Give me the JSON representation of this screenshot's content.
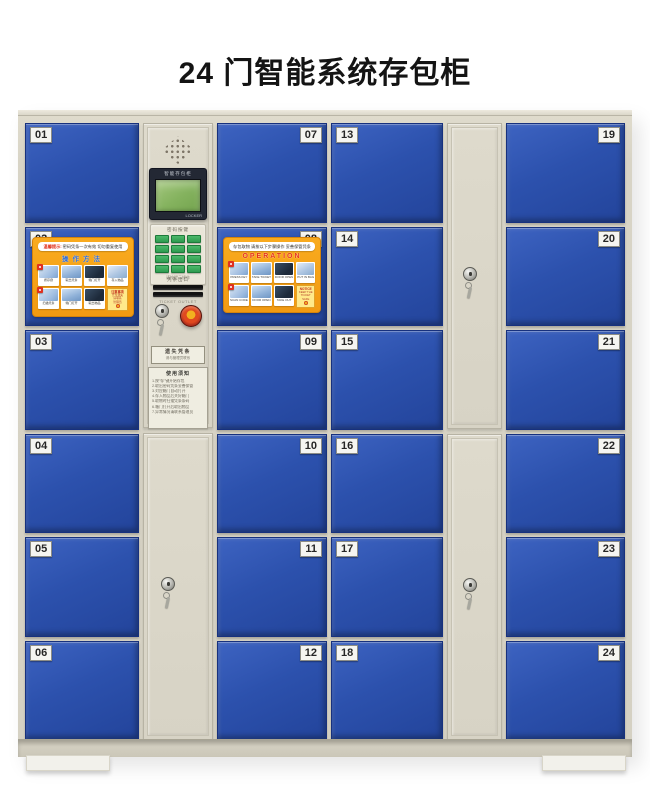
{
  "page": {
    "title": "24 门智能系统存包柜",
    "background": "#ffffff"
  },
  "colors": {
    "frame_beige": "#d8d4c6",
    "door_blue": "#2c51ad",
    "sticker_orange": "#f7a11a",
    "keypad_green": "#2e9b4f",
    "lcd_screen_green": "#84b25e",
    "emergency_button_red": "#c6321c",
    "emergency_button_center_yellow": "#efa51e"
  },
  "cabinet": {
    "door_columns": [
      {
        "id": "col-1",
        "label_side": "left",
        "numbers": [
          "01",
          "02",
          "03",
          "04",
          "05",
          "06"
        ]
      },
      {
        "id": "col-2",
        "label_side": "right",
        "numbers": [
          "07",
          "08",
          "09",
          "10",
          "11",
          "12"
        ]
      },
      {
        "id": "col-3",
        "label_side": "left",
        "numbers": [
          "13",
          "14",
          "15",
          "16",
          "17",
          "18"
        ]
      },
      {
        "id": "col-4",
        "label_side": "right",
        "numbers": [
          "19",
          "20",
          "21",
          "22",
          "23",
          "24"
        ]
      }
    ]
  },
  "control": {
    "screen_header": "智能存包柜",
    "screen_brand": "LOCKER",
    "keypad_label": "密码按键",
    "keypad_note": "请按提示操作",
    "slot_label": "凭条出口",
    "slot_note": "TICKET OUTLET",
    "plate_line1": "遗失凭条",
    "plate_line2": "请与管理员联系",
    "notice_title": "使用须知",
    "notice_lines": [
      "1.按\"存\"键开始存包",
      "2.取出密码凭条妥善保管",
      "3.对应箱门自动打开",
      "4.存入物品后关好箱门",
      "5.取物时扫描凭条条码",
      "6.箱门打开后取出物品",
      "7.异常情况请联系管理员"
    ]
  },
  "stickers": {
    "cn": {
      "door": "02",
      "banner_highlight": "温馨提示:",
      "banner_text": "密码凭条一次有效 切勿重复使用",
      "title": "操作方法",
      "steps": [
        "按存键",
        "取出凭条",
        "箱门打开",
        "存入物品",
        "扫描凭条",
        "箱门打开",
        "取出物品"
      ],
      "note_title": "注意事项",
      "note_lines": [
        "凭条遗失",
        "请联系",
        "管理员"
      ]
    },
    "en": {
      "door": "08",
      "banner_text": "存包取物 请按以下步骤操作 妥善保管凭条",
      "title": "OPERATION",
      "steps": [
        "PRESS KEY",
        "TAKE TICKET",
        "DOOR OPEN",
        "PUT IN BAG",
        "SCAN CODE",
        "DOOR OPEN",
        "TAKE OUT"
      ],
      "note_title": "NOTICE",
      "note_lines": [
        "KEEP THE",
        "TICKET",
        "SAFE"
      ]
    }
  }
}
